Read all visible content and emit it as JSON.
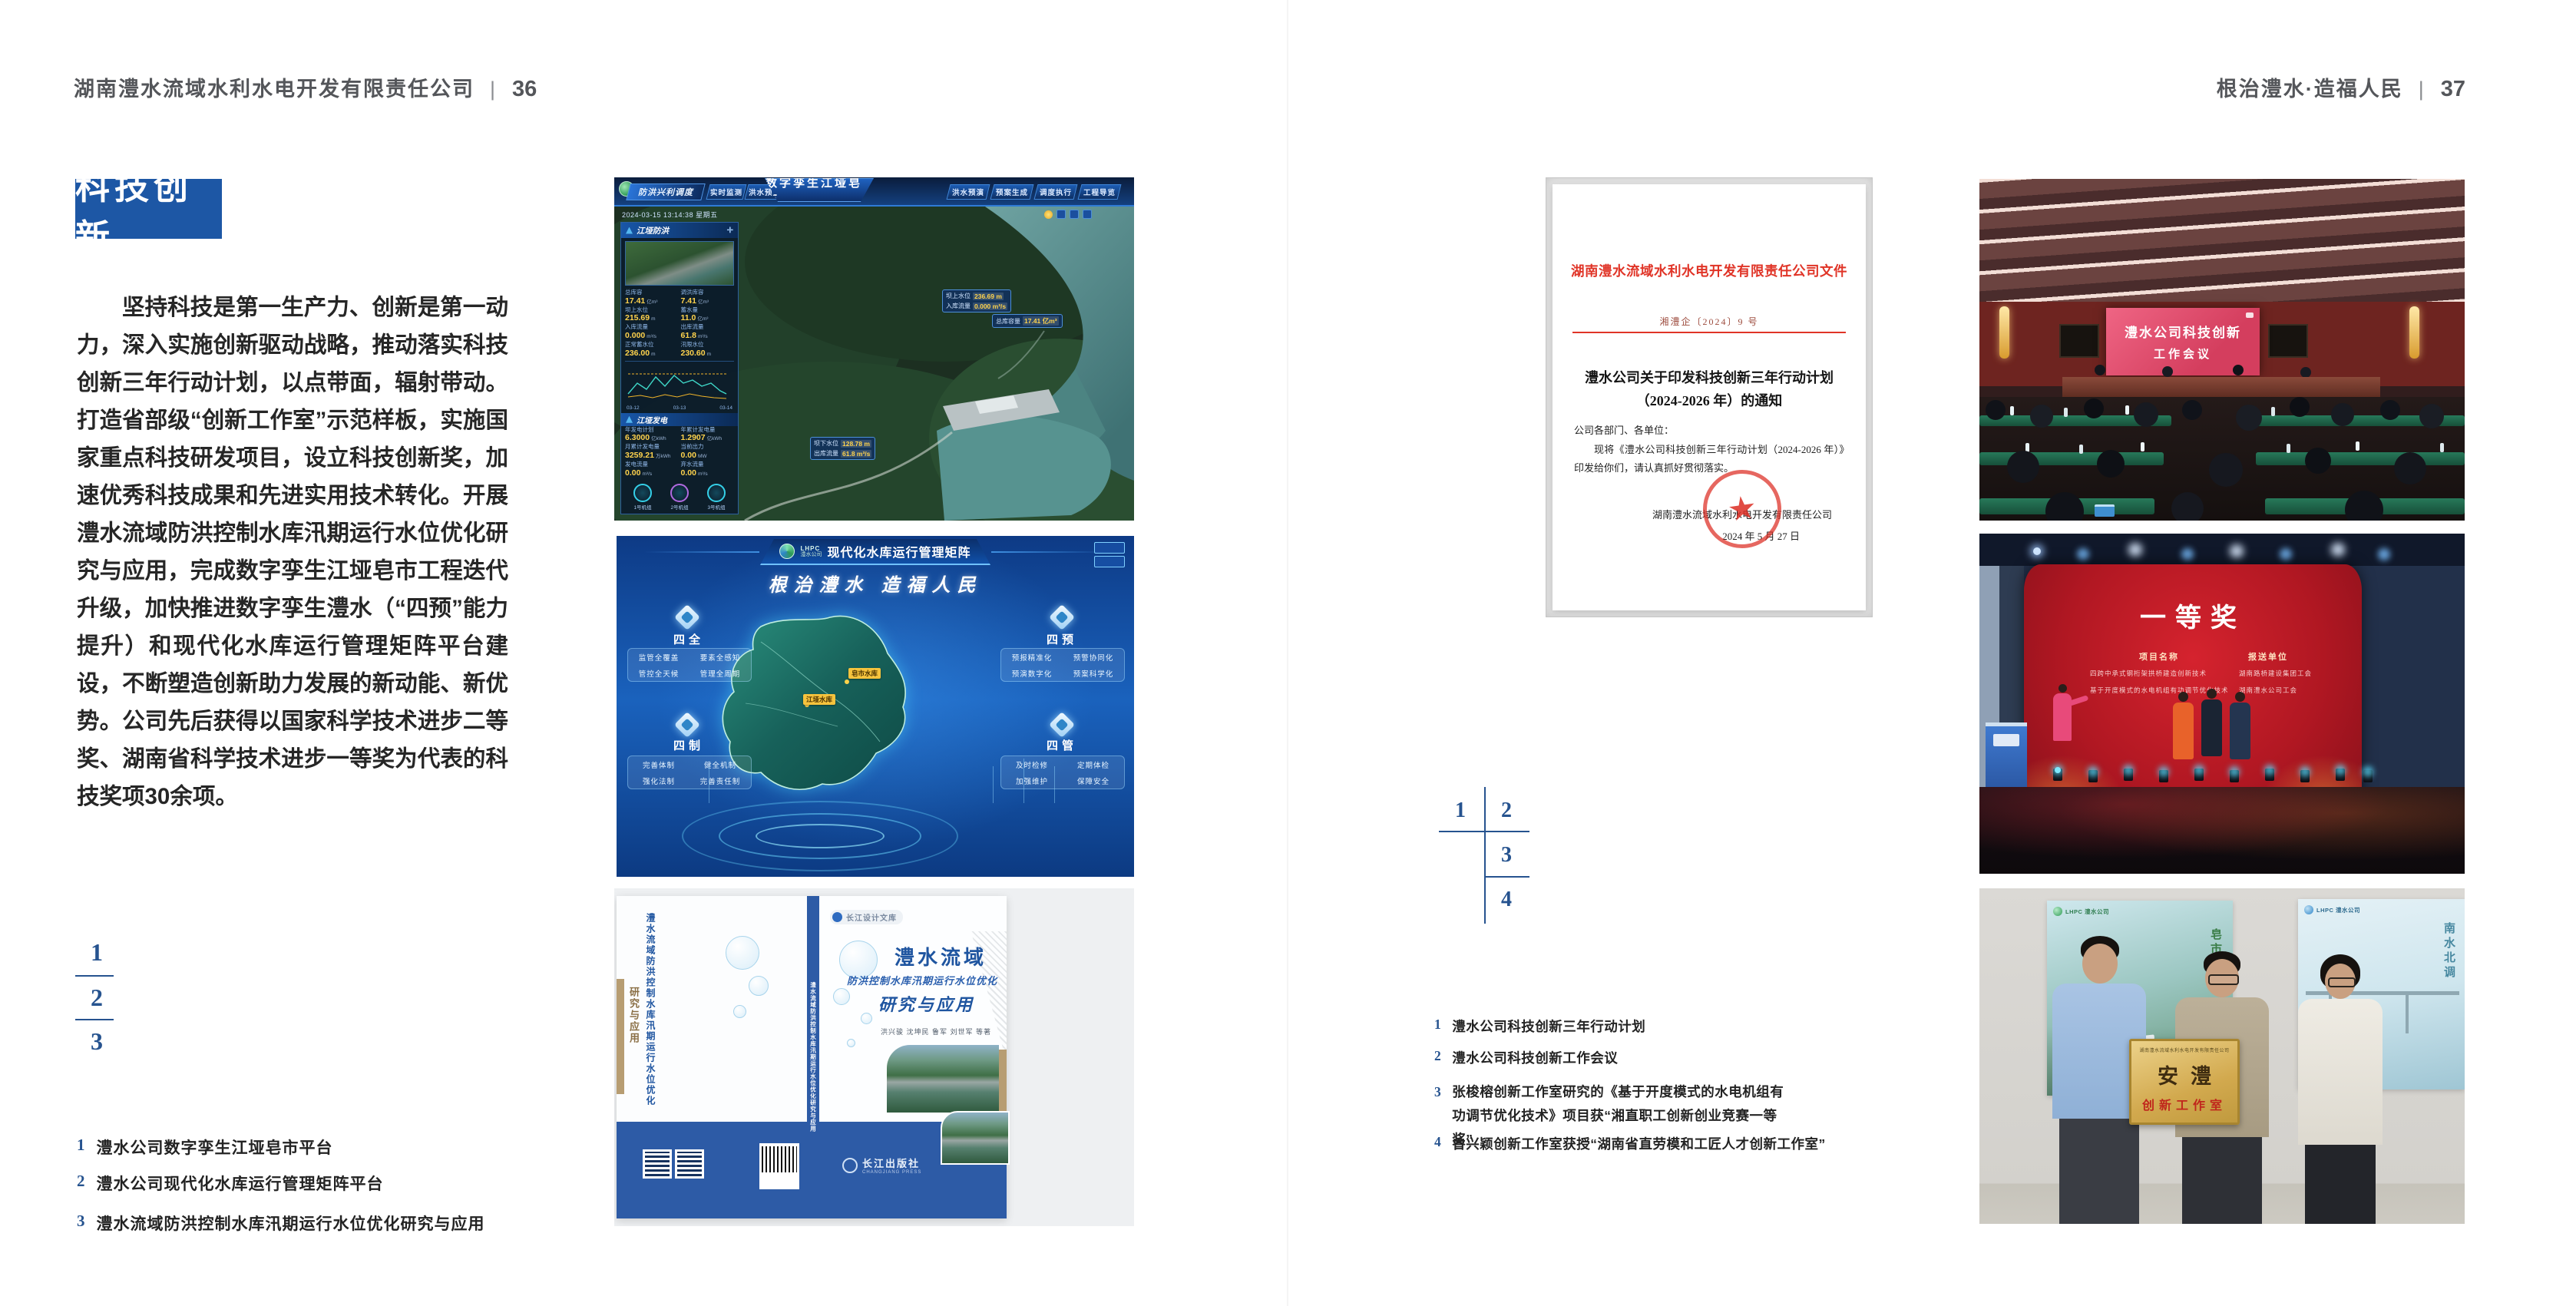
{
  "spread": {
    "left": {
      "header": {
        "company": "湖南澧水流域水利水电开发有限责任公司",
        "separator": "|",
        "page": "36"
      },
      "section_title": "科技创新",
      "body": "坚持科技是第一生产力、创新是第一动力，深入实施创新驱动战略，推动落实科技创新三年行动计划，以点带面，辐射带动。打造省部级“创新工作室”示范样板，实施国家重点科技研发项目，设立科技创新奖，加速优秀科技成果和先进实用技术转化。开展澧水流域防洪控制水库汛期运行水位优化研究与应用，完成数字孪生江垭皂市工程迭代升级，加快推进数字孪生澧水（“四预”能力提升）和现代化水库运行管理矩阵平台建设，不断塑造创新助力发展的新动能、新优势。公司先后获得以国家科学技术进步二等奖、湖南省科学技术进步一等奖为代表的科技奖项30余项。",
      "figure_numbers": [
        "1",
        "2",
        "3"
      ],
      "captions": [
        {
          "num": "1",
          "text": "澧水公司数字孪生江垭皂市平台"
        },
        {
          "num": "2",
          "text": "澧水公司现代化水库运行管理矩阵平台"
        },
        {
          "num": "3",
          "text": "澧水流域防洪控制水库汛期运行水位优化研究与应用"
        }
      ]
    },
    "right": {
      "header": {
        "motto": "根治澧水·造福人民",
        "separator": "|",
        "page": "37"
      },
      "figure_numbers": [
        "1",
        "2",
        "3",
        "4"
      ],
      "captions": [
        {
          "num": "1",
          "text": "澧水公司科技创新三年行动计划"
        },
        {
          "num": "2",
          "text": "澧水公司科技创新工作会议"
        },
        {
          "num": "3",
          "text": "张梭榕创新工作室研究的《基于开度模式的水电机组有功调节优化技术》项目获“湘直职工创新创业竞赛一等奖”"
        },
        {
          "num": "4",
          "text": "曾兴颖创新工作室获授“湖南省直劳模和工匠人才创新工作室”"
        }
      ]
    }
  },
  "figures": {
    "digital_twin": {
      "module": "防洪兴利调度",
      "title": "数字孪生江垭皂市",
      "tabs_left": [
        "实时监测",
        "洪水预报",
        "防洪预警"
      ],
      "tabs_right": [
        "洪水预演",
        "预案生成",
        "调度执行",
        "工程导览"
      ],
      "timestamp": "2024-03-15 13:14:38 星期五",
      "panel_title": "江垭防洪",
      "metrics": [
        {
          "label": "总库容",
          "value": "17.41",
          "unit": "亿m³"
        },
        {
          "label": "调洪库容",
          "value": "7.41",
          "unit": "亿m³"
        },
        {
          "label": "坝上水位",
          "value": "215.69",
          "unit": "m"
        },
        {
          "label": "蓄水量",
          "value": "11.0",
          "unit": "亿m³"
        },
        {
          "label": "入库流量",
          "value": "0.000",
          "unit": "m³/s"
        },
        {
          "label": "出库流量",
          "value": "61.8",
          "unit": "m³/s"
        },
        {
          "label": "正常蓄水位",
          "value": "236.00",
          "unit": "m"
        },
        {
          "label": "汛限水位",
          "value": "230.60",
          "unit": "m"
        }
      ],
      "chart_xticks": [
        "03-12",
        "03-13",
        "03-14"
      ],
      "power_title": "江垭发电",
      "power_metrics": [
        {
          "label": "年发电计划",
          "value": "6.3000",
          "unit": "亿kWh"
        },
        {
          "label": "年累计发电量",
          "value": "1.2907",
          "unit": "亿kWh"
        },
        {
          "label": "月累计发电量",
          "value": "3259.21",
          "unit": "万kWh"
        },
        {
          "label": "当前出力",
          "value": "0.00",
          "unit": "MW"
        },
        {
          "label": "发电流量",
          "value": "0.00",
          "unit": "m³/s"
        },
        {
          "label": "弃水流量",
          "value": "0.00",
          "unit": "m³/s"
        }
      ],
      "units": [
        "1号机组",
        "2号机组",
        "3号机组"
      ],
      "tags": [
        {
          "label": "坝上水位",
          "value": "236.69 m"
        },
        {
          "label": "入库流量",
          "value": "0.000 m³/s"
        },
        {
          "label": "总库容量",
          "value": "17.41 亿m³"
        },
        {
          "label": "坝下水位",
          "value": "128.78 m"
        },
        {
          "label": "出库流量",
          "value": "61.8 m³/s"
        }
      ]
    },
    "matrix": {
      "brand_en": "LHPC",
      "brand": "澧水公司",
      "title": "现代化水库运行管理矩阵",
      "slogan": "根治澧水 造福人民",
      "groups": [
        {
          "name": "四全",
          "items": [
            "监管全覆盖",
            "要素全感知",
            "管控全天候",
            "管理全周期"
          ]
        },
        {
          "name": "四预",
          "items": [
            "预报精准化",
            "预警协同化",
            "预演数字化",
            "预案科学化"
          ]
        },
        {
          "name": "四制",
          "items": [
            "完善体制",
            "健全机制",
            "强化法制",
            "完善责任制"
          ]
        },
        {
          "name": "四管",
          "items": [
            "及时检修",
            "定期体检",
            "加强维护",
            "保障安全"
          ]
        }
      ],
      "map_labels": [
        "江垭水库",
        "皂市水库"
      ]
    },
    "book": {
      "series": "长江设计文库",
      "title_main": "澧水流域",
      "title_sub": "防洪控制水库汛期运行水位优化",
      "title_tail": "研究与应用",
      "authors": "洪兴骏 沈坤民 鲁军 刘世军 等著",
      "publisher": "长江出版社",
      "publisher_en": "CHANGJIANG PRESS",
      "spine_title": "澧水流域防洪控制水库汛期运行水位优化研究与应用",
      "back_title": "澧水流域防洪控制水库汛期运行水位优化",
      "back_tail": "研究与应用"
    },
    "document": {
      "header": "湖南澧水流域水利水电开发有限责任公司文件",
      "doc_number": "湘澧企〔2024〕9 号",
      "title_line1": "澧水公司关于印发科技创新三年行动计划",
      "title_line2": "（2024-2026 年）的通知",
      "salutation": "公司各部门、各单位：",
      "body": "现将《澧水公司科技创新三年行动计划（2024-2026 年）》印发给你们，请认真抓好贯彻落实。",
      "signature": "湖南澧水流域水利水电开发有限责任公司",
      "date": "2024 年 5 月 27 日"
    },
    "meeting": {
      "screen_line1": "澧水公司科技创新",
      "screen_line2": "工作会议"
    },
    "award": {
      "title": "一等奖",
      "col1_header": "项目名称",
      "col1_items": [
        "四跨中承式钢桁架拱桥建造创新技术",
        "基于开度模式的水电机组有功调节优化技术"
      ],
      "col2_header": "报送单位",
      "col2_items": [
        "湖南路桥建设集团工会",
        "湖南澧水公司工会"
      ]
    },
    "plaque": {
      "org": "湖南澧水流域水利水电开发有限责任公司",
      "main": "安澧",
      "sub": "创新工作室",
      "poster_left_brand": "LHPC 澧水公司",
      "poster_left_label": "皂市水库",
      "poster_right_brand": "LHPC 澧水公司",
      "poster_right_label": "南水北调"
    }
  },
  "colors": {
    "accent_blue": "#1d57a5",
    "index_blue": "#26538f",
    "doc_red": "#e03427",
    "meeting_screen_pink": "#e0506e",
    "award_red": "#b01722",
    "plaque_gold": "#d2a94e"
  }
}
